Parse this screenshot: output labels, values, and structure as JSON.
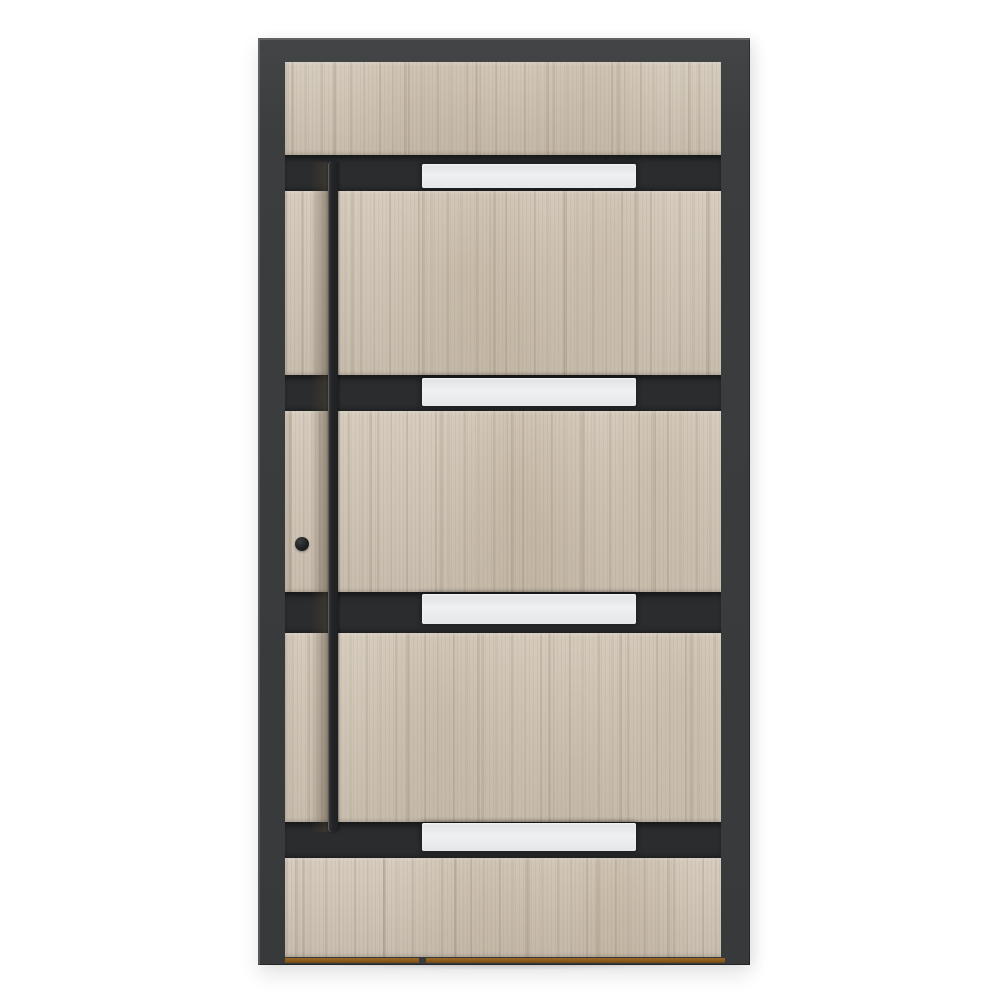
{
  "product": {
    "name": "modern-front-entry-door",
    "style": "horizontal oak panels with black frame, glass slits and bar handle"
  },
  "door": {
    "wood_panel_count": 5,
    "glass_slit_count": 4,
    "handle_type": "vertical-bar-pull",
    "handle_side": "left",
    "lock": "cylinder-dot",
    "threshold": "brown-sill",
    "colors": {
      "background": "#ffffff",
      "frame": "#3b3d3f",
      "band": "#2a2c2e",
      "wood": "#d2c7b7",
      "glass": "#eaeced",
      "handle": "#242628",
      "keyhole": "#1b1d1f",
      "threshold": "#8a5a1e"
    }
  }
}
